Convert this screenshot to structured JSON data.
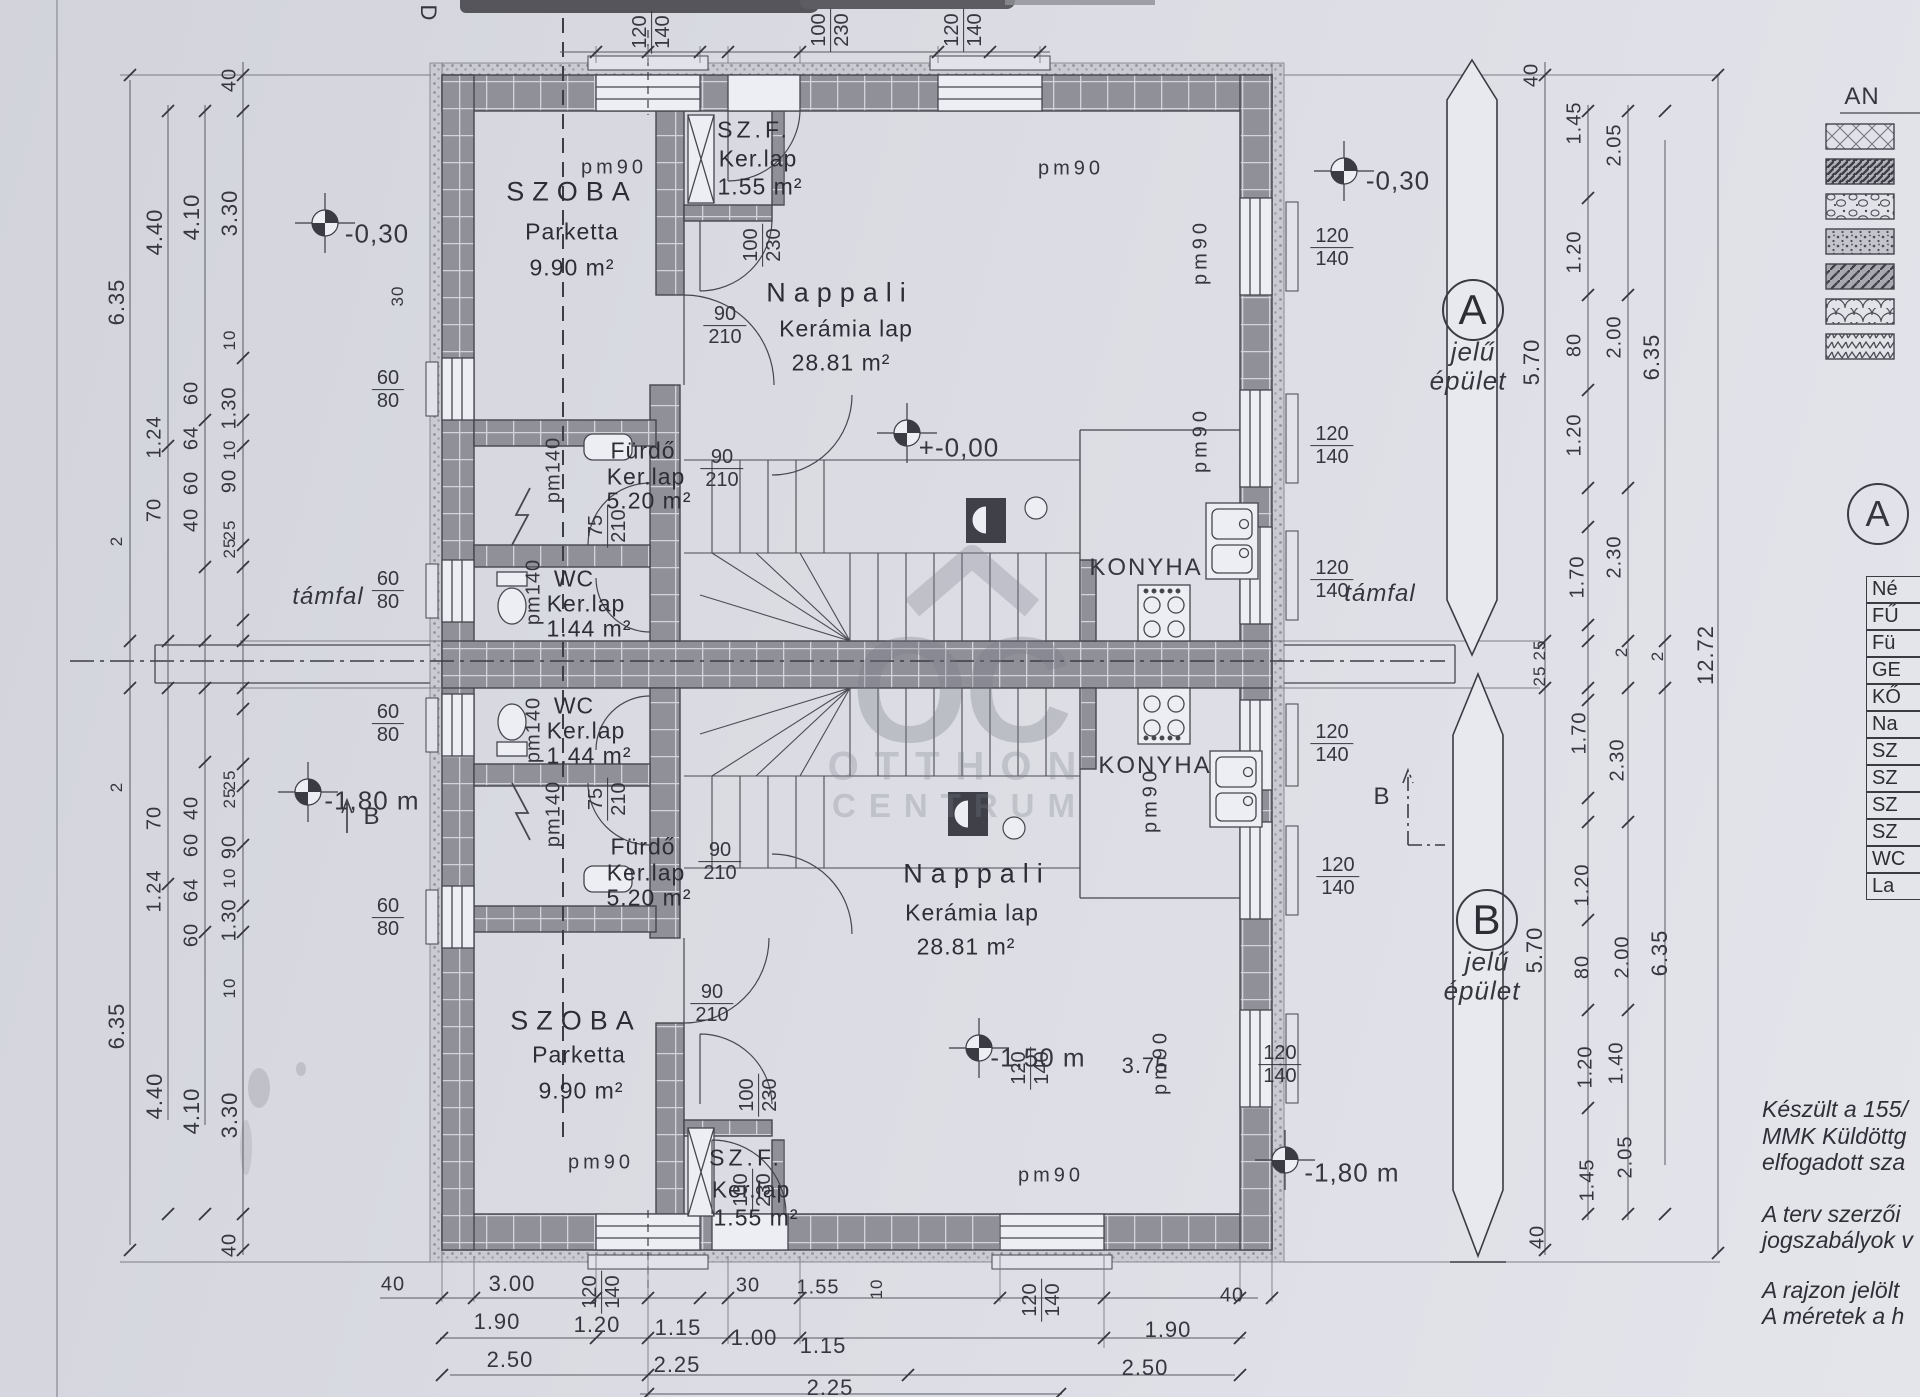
{
  "watermark": {
    "monogram": "OC",
    "line1": "OTTHON",
    "line2": "CENTRUM"
  },
  "rooms": {
    "szoba": {
      "name": "SZOBA",
      "floor": "Parketta",
      "area": "9.90 m²"
    },
    "szf": {
      "name": "SZ.F.",
      "floor": "Ker.lap",
      "area": "1.55 m²"
    },
    "nappali": {
      "name": "Nappali",
      "floor": "Kerámia lap",
      "area": "28.81 m²"
    },
    "furdo": {
      "name": "Fürdő",
      "floor": "Ker.lap",
      "area": "5.20 m²"
    },
    "wc": {
      "name": "WC",
      "floor": "Ker.lap",
      "area": "1.44 m²"
    },
    "konyha": {
      "name": "KONYHA"
    }
  },
  "elevations": {
    "e_030": "-0,30",
    "e_000": "+-0,00",
    "e_150": "-1,50 m",
    "e_180": "-1,80 m"
  },
  "marks": {
    "tamfal": "támfal",
    "d": "D",
    "b": "B"
  },
  "buildings": {
    "a": "A",
    "b": "B",
    "sub1": "jelű",
    "sub2": "épület"
  },
  "detail_circle": "A",
  "legend": {
    "title": "AN"
  },
  "table": {
    "rows": [
      "Né",
      "FŰ",
      "Fü",
      "GE",
      "KŐ",
      "Na",
      "SZ",
      "SZ",
      "SZ",
      "SZ",
      "WC",
      "La"
    ]
  },
  "notes": [
    "Készült a 155/",
    "MMK Küldöttg",
    "elfogadott sza",
    "A terv szerzői",
    "jogszabályok v",
    "A rajzon jelölt",
    "A méretek a h"
  ],
  "pm": {
    "pm90": "pm90",
    "pm140": "pm140"
  },
  "dims": {
    "left1": [
      "6.35",
      "2",
      "2",
      "6.35"
    ],
    "left2": [
      "4.40",
      "1.24",
      "70",
      "70",
      "1.24",
      "4.40"
    ],
    "left3": [
      "4.10",
      "60",
      "64",
      "60",
      "40",
      "40",
      "60",
      "64",
      "60",
      "4.10"
    ],
    "left4": [
      "40",
      "3.30",
      "10",
      "1.30",
      "10",
      "90",
      "25",
      "25",
      "25",
      "25",
      "90",
      "10",
      "1.30",
      "10",
      "3.30",
      "40"
    ],
    "right1": [
      "40",
      "5.70",
      "25",
      "25",
      "5.70",
      "40"
    ],
    "right2": [
      "1.45",
      "1.20",
      "80",
      "1.20",
      "1.70",
      "1.70",
      "1.20",
      "80",
      "1.20",
      "1.45"
    ],
    "right3": [
      "2.05",
      "2.00",
      "2.30",
      "2",
      "2",
      "2.30",
      "2.00",
      "2.05",
      "1.40"
    ],
    "right4": [
      "6.35",
      "6.35",
      "12.72"
    ],
    "bottom1": [
      "40",
      "3.00",
      "30",
      "1.55",
      "10",
      "40"
    ],
    "bottom2": [
      "1.90",
      "1.20",
      "1.15",
      "1.00",
      "1.15",
      "1.90"
    ],
    "bottom3": [
      "2.50",
      "2.25",
      "2.50",
      "2.25"
    ],
    "interior": [
      "3.75",
      "30"
    ],
    "frac_top": [
      [
        "120",
        "140"
      ],
      [
        "100",
        "230"
      ],
      [
        "120",
        "140"
      ]
    ],
    "frac_right": [
      [
        "120",
        "140"
      ],
      [
        "120",
        "140"
      ],
      [
        "120",
        "140"
      ],
      [
        "120",
        "140"
      ],
      [
        "120",
        "140"
      ],
      [
        "120",
        "140"
      ]
    ],
    "frac_doors": [
      [
        "90",
        "210"
      ],
      [
        "90",
        "210"
      ],
      [
        "90",
        "210"
      ],
      [
        "90",
        "210"
      ]
    ],
    "frac_v": [
      [
        "100",
        "230"
      ],
      [
        "100",
        "230"
      ],
      [
        "100",
        "230"
      ],
      [
        "75",
        "210"
      ],
      [
        "75",
        "210"
      ]
    ],
    "frac_bottom": [
      [
        "120",
        "140"
      ],
      [
        "120",
        "140"
      ],
      [
        "120",
        "140"
      ]
    ],
    "frac_left": [
      [
        "60",
        "80"
      ],
      [
        "60",
        "80"
      ],
      [
        "60",
        "80"
      ],
      [
        "60",
        "80"
      ]
    ]
  }
}
